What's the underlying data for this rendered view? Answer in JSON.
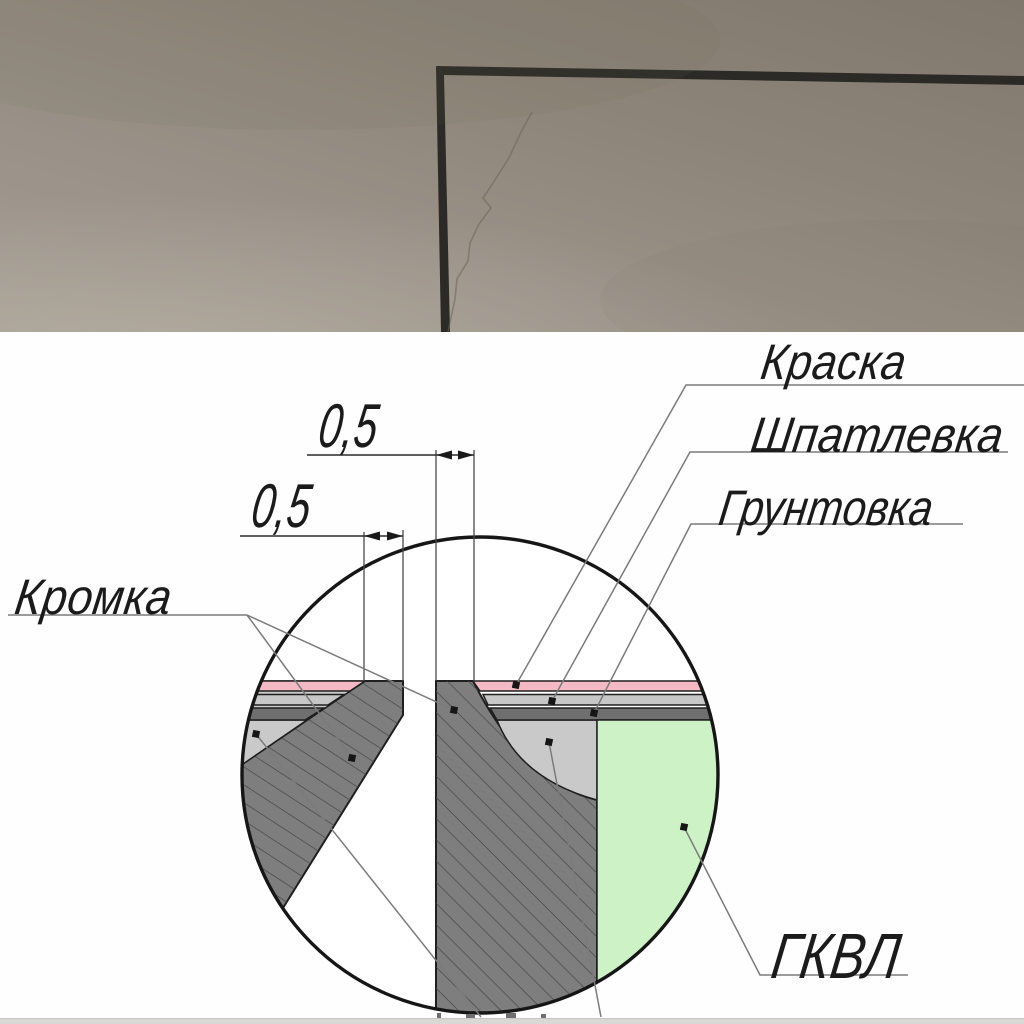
{
  "diagram": {
    "callouts": {
      "paint": "Краска",
      "filler": "Шпатлевка",
      "primer": "Грунтовка",
      "edge": "Кромка",
      "board": "ГКВЛ"
    },
    "dimensions": {
      "upper": "0,5",
      "lower": "0,5"
    },
    "colors": {
      "paint_layer": "#f3bac5",
      "filler_layer": "#c7c7c7",
      "primer_layer": "#6f6f70",
      "joint_fill": "#c9c9c9",
      "board_green": "#cdf2c6",
      "hatch_base": "#7e7e7e",
      "line": "#1a1a1a"
    }
  },
  "photo": {
    "colors": {
      "wall": "#958d82",
      "corner_mark": "#2b2a26"
    }
  }
}
